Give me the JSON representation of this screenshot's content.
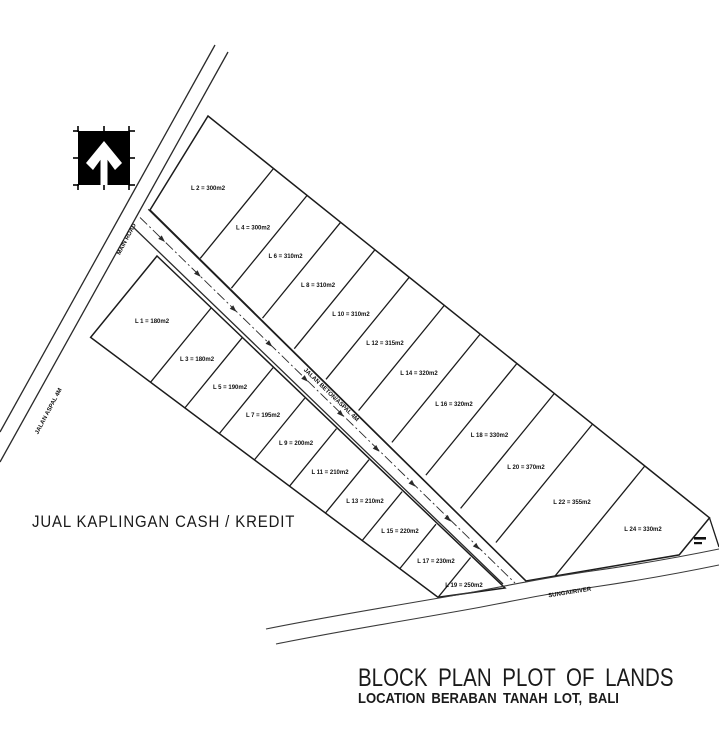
{
  "title_block": {
    "title": "BLOCK PLAN PLOT OF LANDS",
    "subtitle": "LOCATION BERABAN TANAH LOT, BALI"
  },
  "sale_banner": "JUAL KAPLINGAN CASH / KREDIT",
  "roads": {
    "main_road_label_upper": "MAIN ROAD",
    "main_road_label_lower": "JALAN ASPAL 4M",
    "access_road_label": "JALAN BETON/ASPAL 4M",
    "river_label": "SUNGAI/RIVER"
  },
  "icons": {
    "north_arrow": "north-arrow-icon"
  },
  "colors": {
    "line": "#1c1c1c",
    "text": "#101010",
    "background": "#ffffff",
    "north_box": "#000000"
  },
  "plots": {
    "top_row": [
      {
        "id": "L 2",
        "area_m2": 300,
        "label": "L 2 = 300m2"
      },
      {
        "id": "L 4",
        "area_m2": 300,
        "label": "L 4 = 300m2"
      },
      {
        "id": "L 6",
        "area_m2": 310,
        "label": "L 6 = 310m2"
      },
      {
        "id": "L 8",
        "area_m2": 310,
        "label": "L 8 = 310m2"
      },
      {
        "id": "L 10",
        "area_m2": 310,
        "label": "L 10 = 310m2"
      },
      {
        "id": "L 12",
        "area_m2": 315,
        "label": "L 12 = 315m2"
      },
      {
        "id": "L 14",
        "area_m2": 320,
        "label": "L 14 = 320m2"
      },
      {
        "id": "L 16",
        "area_m2": 320,
        "label": "L 16 = 320m2"
      },
      {
        "id": "L 18",
        "area_m2": 330,
        "label": "L 18 = 330m2"
      },
      {
        "id": "L 20",
        "area_m2": 370,
        "label": "L 20 = 370m2"
      },
      {
        "id": "L 22",
        "area_m2": 355,
        "label": "L 22 = 355m2"
      },
      {
        "id": "L 24",
        "area_m2": 330,
        "label": "L 24 = 330m2"
      }
    ],
    "bottom_row": [
      {
        "id": "L 1",
        "area_m2": 180,
        "label": "L 1 = 180m2"
      },
      {
        "id": "L 3",
        "area_m2": 180,
        "label": "L 3 = 180m2"
      },
      {
        "id": "L 5",
        "area_m2": 190,
        "label": "L 5 = 190m2"
      },
      {
        "id": "L 7",
        "area_m2": 195,
        "label": "L 7 = 195m2"
      },
      {
        "id": "L 9",
        "area_m2": 200,
        "label": "L 9 = 200m2"
      },
      {
        "id": "L 11",
        "area_m2": 210,
        "label": "L 11 = 210m2"
      },
      {
        "id": "L 13",
        "area_m2": 210,
        "label": "L 13 = 210m2"
      },
      {
        "id": "L 15",
        "area_m2": 220,
        "label": "L 15 = 220m2"
      },
      {
        "id": "L 17",
        "area_m2": 230,
        "label": "L 17 = 230m2"
      },
      {
        "id": "L 19",
        "area_m2": 250,
        "label": "L 19 = 250m2"
      }
    ]
  }
}
